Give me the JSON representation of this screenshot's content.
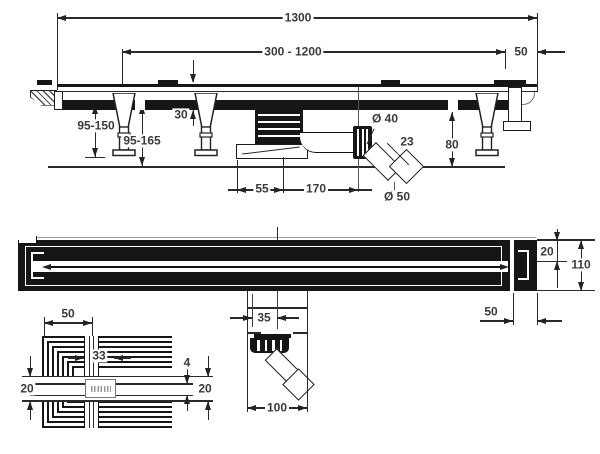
{
  "side_view": {
    "d_total": "1300",
    "d_adjust": "300 - 1200",
    "d_end": "50",
    "d_leg": "95-150",
    "d_install": "95-165",
    "d_grate_h": "30",
    "d_outlet_dia": "Ø 40",
    "d_pipe": "23",
    "d_height": "80",
    "d_trap": "55",
    "d_outlet_x": "170",
    "d_pipe_dia": "Ø 50"
  },
  "plan_view": {
    "d_edge": "20",
    "d_width": "110",
    "d_end": "50"
  },
  "outlet_view": {
    "d_offset": "35",
    "d_body": "100"
  },
  "corner_view": {
    "d_edge": "50",
    "d_grate": "33",
    "d_slot": "4",
    "d_band_l": "20",
    "d_band_r": "20"
  }
}
